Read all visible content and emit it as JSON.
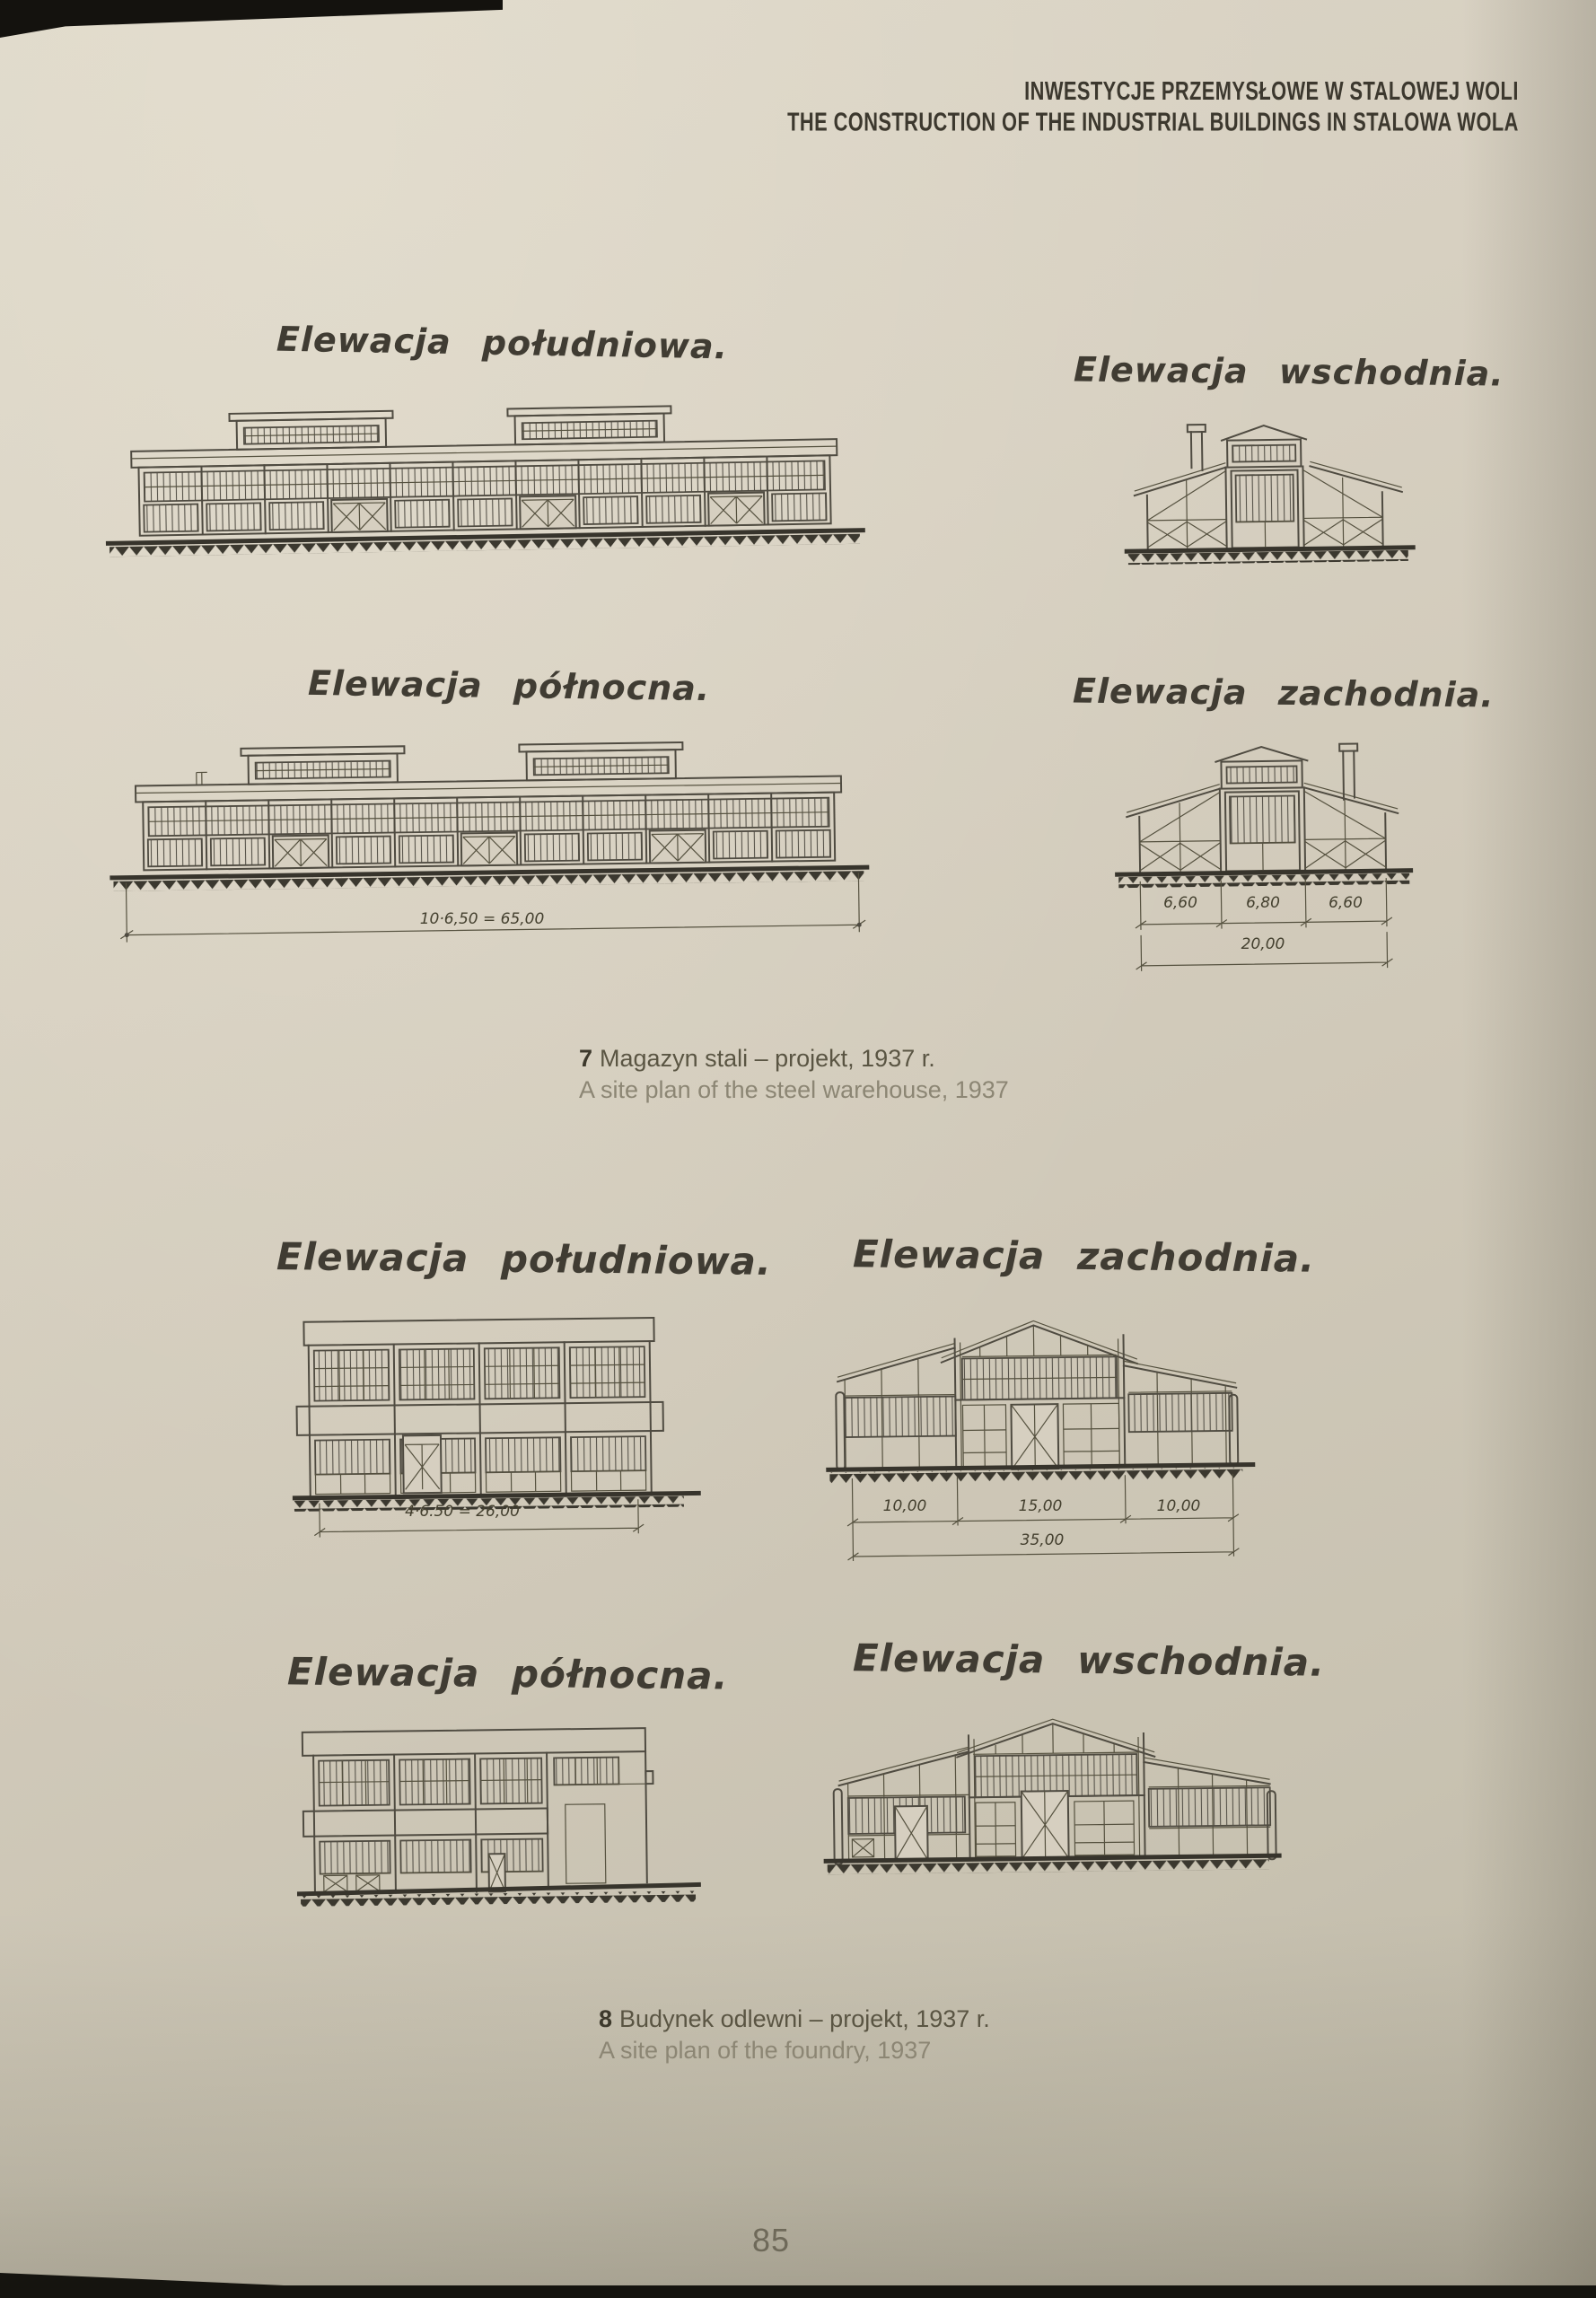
{
  "header": {
    "line1": "INWESTYCJE PRZEMYSŁOWE W STALOWEJ WOLI",
    "line2": "THE CONSTRUCTION OF THE INDUSTRIAL BUILDINGS IN STALOWA WOLA"
  },
  "colors": {
    "paper": "#d2cbbc",
    "ink": "#4f4b41",
    "caption_muted": "#8c8674"
  },
  "figure7": {
    "south_title": "Elewacja południowa.",
    "east_title": "Elewacja wschodnia.",
    "north_title": "Elewacja północna.",
    "west_title": "Elewacja zachodnia.",
    "north_dim_total": "10·6,50 = 65,00",
    "west_dims": {
      "d1": "6,60",
      "d2": "6,80",
      "d3": "6,60",
      "total": "20,00"
    },
    "caption_number": "7",
    "caption_pl": "Magazyn stali – projekt, 1937 r.",
    "caption_en": "A site plan of the steel warehouse, 1937"
  },
  "figure8": {
    "south_title": "Elewacja południowa.",
    "west_title": "Elewacja zachodnia.",
    "north_title": "Elewacja północna.",
    "east_title": "Elewacja wschodnia.",
    "south_dim_total": "4·6.50 = 26,00",
    "west_dims": {
      "d1": "10,00",
      "d2": "15,00",
      "d3": "10,00",
      "total": "35,00"
    },
    "caption_number": "8",
    "caption_pl": "Budynek odlewni – projekt, 1937 r.",
    "caption_en": "A site plan of the foundry, 1937"
  },
  "footer": {
    "page_number": "85"
  }
}
